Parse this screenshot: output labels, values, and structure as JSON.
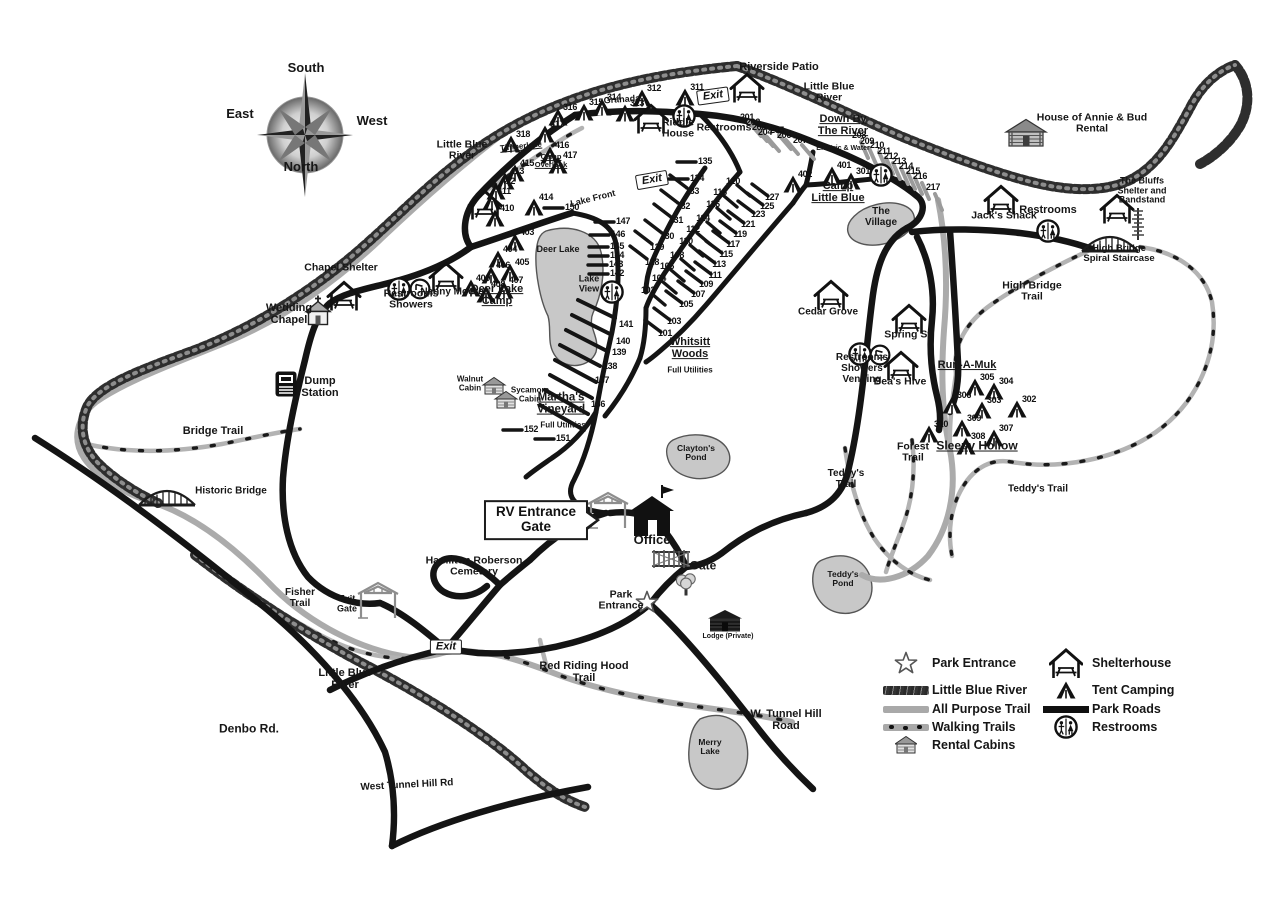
{
  "map_name": "campground-park-map",
  "colors": {
    "road": "#141414",
    "trail": "#ababab",
    "river": "#2e2e2e",
    "lake": "#c8c8c8",
    "text": "#161616"
  },
  "compass": {
    "top": "South",
    "left": "East",
    "right": "West",
    "bottom": "North"
  },
  "legend": {
    "items_left": [
      {
        "icon": "park-entrance-star",
        "label": "Park Entrance"
      },
      {
        "icon": "river-swatch",
        "label": "Little Blue River"
      },
      {
        "icon": "all-purpose-trail-swatch",
        "label": "All Purpose Trail"
      },
      {
        "icon": "walking-trails-swatch",
        "label": "Walking Trails"
      },
      {
        "icon": "rental-cabin",
        "label": "Rental Cabins"
      }
    ],
    "items_right": [
      {
        "icon": "shelterhouse",
        "label": "Shelterhouse"
      },
      {
        "icon": "tent",
        "label": "Tent Camping"
      },
      {
        "icon": "park-roads-swatch",
        "label": "Park Roads"
      },
      {
        "icon": "restrooms",
        "label": "Restrooms"
      }
    ]
  },
  "labels": [
    {
      "id": "compass-south",
      "text": "South",
      "x": 306,
      "y": 68,
      "fs": 13
    },
    {
      "id": "compass-east",
      "text": "East",
      "x": 240,
      "y": 114,
      "fs": 13
    },
    {
      "id": "compass-west",
      "text": "West",
      "x": 372,
      "y": 121,
      "fs": 13
    },
    {
      "id": "compass-north",
      "text": "North",
      "x": 301,
      "y": 167,
      "fs": 13
    },
    {
      "id": "riverside-patio",
      "text": "Riverside Patio",
      "x": 779,
      "y": 68,
      "fs": 11
    },
    {
      "id": "little-blue-river-ne",
      "text": "Little Blue\nRiver",
      "x": 829,
      "y": 93,
      "fs": 10.5
    },
    {
      "id": "house-of-annie-bud",
      "text": "House of Annie & Bud\nRental",
      "x": 1092,
      "y": 124,
      "fs": 10.5
    },
    {
      "id": "granada",
      "text": "Granada",
      "x": 622,
      "y": 100,
      "fs": 9,
      "r": -4
    },
    {
      "id": "riddle-house",
      "text": "Riddle\nHouse",
      "x": 678,
      "y": 129,
      "fs": 10.5
    },
    {
      "id": "restrooms-top",
      "text": "Restrooms",
      "x": 724,
      "y": 128,
      "fs": 10.5
    },
    {
      "id": "down-by-the-river",
      "text": "Down By\nThe River",
      "x": 843,
      "y": 126,
      "fs": 11,
      "u": true
    },
    {
      "id": "electric-and-water",
      "text": "Electric & Water",
      "x": 843,
      "y": 149,
      "fs": 7
    },
    {
      "id": "little-blue-river-w",
      "text": "Little Blue\nRiver",
      "x": 462,
      "y": 151,
      "fs": 10.5
    },
    {
      "id": "timberlake",
      "text": "Timberlake",
      "x": 521,
      "y": 147,
      "fs": 8,
      "u": true,
      "r": -6
    },
    {
      "id": "camp-overlook",
      "text": "Camp\nOverlook",
      "x": 551,
      "y": 161,
      "fs": 7.5,
      "u": true
    },
    {
      "id": "camp-little-blue",
      "text": "Camp\nLittle Blue",
      "x": 838,
      "y": 193,
      "fs": 11,
      "u": true
    },
    {
      "id": "the-village",
      "text": "The\nVillage",
      "x": 881,
      "y": 218,
      "fs": 10
    },
    {
      "id": "jacks-shack",
      "text": "Jack's Shack",
      "x": 1004,
      "y": 216,
      "fs": 10.5
    },
    {
      "id": "restrooms-ne",
      "text": "Restrooms",
      "x": 1048,
      "y": 211,
      "fs": 11
    },
    {
      "id": "the-bluffs",
      "text": "The Bluffs\nShelter and\nBandstand",
      "x": 1142,
      "y": 191,
      "fs": 9
    },
    {
      "id": "lake-front",
      "text": "Lake Front",
      "x": 593,
      "y": 199,
      "fs": 9,
      "r": -14
    },
    {
      "id": "deer-lake",
      "text": "Deer Lake",
      "x": 558,
      "y": 250,
      "fs": 9
    },
    {
      "id": "high-bridge-spiral-staircase",
      "text": "High Bridge\nSpiral Staircase",
      "x": 1119,
      "y": 254,
      "fs": 9.5
    },
    {
      "id": "high-bridge-trail",
      "text": "High Bridge\nTrail",
      "x": 1032,
      "y": 292,
      "fs": 10.5
    },
    {
      "id": "chapel-shelter",
      "text": "Chapel Shelter",
      "x": 341,
      "y": 268,
      "fs": 10.5
    },
    {
      "id": "restrooms-showers-w",
      "text": "Restrooms\nShowers",
      "x": 411,
      "y": 300,
      "fs": 10.5
    },
    {
      "id": "nanny-moore",
      "text": "Nanny Moore",
      "x": 452,
      "y": 293,
      "fs": 10
    },
    {
      "id": "deer-lake-camp",
      "text": "Deer Lake\nCamp",
      "x": 497,
      "y": 296,
      "fs": 11,
      "u": true
    },
    {
      "id": "lake-view",
      "text": "Lake\nView",
      "x": 589,
      "y": 284,
      "fs": 9
    },
    {
      "id": "cedar-grove",
      "text": "Cedar Grove",
      "x": 828,
      "y": 313,
      "fs": 10
    },
    {
      "id": "wedding-chapel",
      "text": "Wedding\nChapel",
      "x": 289,
      "y": 315,
      "fs": 11
    },
    {
      "id": "spring-st",
      "text": "Spring St.",
      "x": 909,
      "y": 335,
      "fs": 10.5
    },
    {
      "id": "restrooms-showers-vending",
      "text": "Restrooms\nShowers\nVending",
      "x": 862,
      "y": 369,
      "fs": 10
    },
    {
      "id": "beas-hive",
      "text": "Bea's Hive",
      "x": 900,
      "y": 382,
      "fs": 10.5
    },
    {
      "id": "run-a-muk",
      "text": "Run-A-Muk",
      "x": 967,
      "y": 366,
      "fs": 11,
      "u": true
    },
    {
      "id": "whitsitt-woods",
      "text": "Whitsitt\nWoods",
      "x": 690,
      "y": 349,
      "fs": 11,
      "u": true
    },
    {
      "id": "whitsitt-full-utilities",
      "text": "Full Utilities",
      "x": 690,
      "y": 371,
      "fs": 8
    },
    {
      "id": "sleepy-hollow",
      "text": "Sleepy Hollow",
      "x": 977,
      "y": 446,
      "fs": 12,
      "u": true
    },
    {
      "id": "dump-station",
      "text": "Dump\nStation",
      "x": 320,
      "y": 388,
      "fs": 11
    },
    {
      "id": "walnut-cabin",
      "text": "Walnut\nCabin",
      "x": 470,
      "y": 384,
      "fs": 8
    },
    {
      "id": "sycamore-cabin",
      "text": "Sycamore\nCabin",
      "x": 530,
      "y": 395,
      "fs": 8
    },
    {
      "id": "marthas-vineyard",
      "text": "Martha's\nVineyard",
      "x": 561,
      "y": 404,
      "fs": 11.5,
      "u": true
    },
    {
      "id": "marthas-full-utilities",
      "text": "Full Utilities",
      "x": 563,
      "y": 426,
      "fs": 8
    },
    {
      "id": "bridge-trail",
      "text": "Bridge Trail",
      "x": 213,
      "y": 432,
      "fs": 11
    },
    {
      "id": "claytons-pond",
      "text": "Clayton's\nPond",
      "x": 696,
      "y": 453,
      "fs": 8.5
    },
    {
      "id": "forest-trail",
      "text": "Forest\nTrail",
      "x": 913,
      "y": 453,
      "fs": 10.5
    },
    {
      "id": "teddys-trail-w",
      "text": "Teddy's\nTrail",
      "x": 846,
      "y": 480,
      "fs": 10
    },
    {
      "id": "teddys-trail-e",
      "text": "Teddy's Trail",
      "x": 1038,
      "y": 490,
      "fs": 10
    },
    {
      "id": "historic-bridge",
      "text": "Historic Bridge",
      "x": 231,
      "y": 492,
      "fs": 10
    },
    {
      "id": "office",
      "text": "Office",
      "x": 652,
      "y": 540,
      "fs": 13
    },
    {
      "id": "hamilton-roberson-cemetery",
      "text": "Hamilton Roberson\nCemetery",
      "x": 474,
      "y": 567,
      "fs": 10.5
    },
    {
      "id": "gate",
      "text": "Gate",
      "x": 703,
      "y": 566,
      "fs": 12
    },
    {
      "id": "teddys-pond",
      "text": "Teddy's\nPond",
      "x": 843,
      "y": 579,
      "fs": 8.5
    },
    {
      "id": "fisher-trail",
      "text": "Fisher\nTrail",
      "x": 300,
      "y": 599,
      "fs": 10
    },
    {
      "id": "exit-gate",
      "text": "Exit\nGate",
      "x": 347,
      "y": 604,
      "fs": 9
    },
    {
      "id": "park-entrance",
      "text": "Park\nEntrance",
      "x": 621,
      "y": 601,
      "fs": 10.5
    },
    {
      "id": "lodge-private",
      "text": "Lodge (Private)",
      "x": 728,
      "y": 637,
      "fs": 7
    },
    {
      "id": "little-blue-river-s",
      "text": "Little Blue\nRiver",
      "x": 345,
      "y": 680,
      "fs": 11
    },
    {
      "id": "red-riding-hood-trail",
      "text": "Red Riding Hood\nTrail",
      "x": 584,
      "y": 673,
      "fs": 11
    },
    {
      "id": "denbo-rd",
      "text": "Denbo Rd.",
      "x": 249,
      "y": 729,
      "fs": 12
    },
    {
      "id": "w-tunnel-hill-road",
      "text": "W. Tunnel Hill\nRoad",
      "x": 786,
      "y": 721,
      "fs": 11
    },
    {
      "id": "merry-lake",
      "text": "Merry\nLake",
      "x": 710,
      "y": 747,
      "fs": 8.5
    },
    {
      "id": "west-tunnel-hill-rd",
      "text": "West Tunnel Hill Rd",
      "x": 407,
      "y": 786,
      "fs": 10,
      "r": -3
    }
  ],
  "signs": [
    {
      "type": "exit",
      "text": "Exit",
      "x": 713,
      "y": 96,
      "r": -8
    },
    {
      "type": "exit",
      "text": "Exit",
      "x": 652,
      "y": 180,
      "r": -10
    },
    {
      "type": "exit",
      "text": "Exit",
      "x": 446,
      "y": 647,
      "r": 0
    },
    {
      "type": "rv",
      "text": "RV Entrance\nGate",
      "x": 536,
      "y": 520,
      "r": 0
    }
  ],
  "campsites": [
    [
      101,
      665,
      333
    ],
    [
      102,
      648,
      290
    ],
    [
      103,
      674,
      321
    ],
    [
      104,
      659,
      278
    ],
    [
      105,
      686,
      304
    ],
    [
      106,
      667,
      266
    ],
    [
      107,
      698,
      294
    ],
    [
      108,
      677,
      255
    ],
    [
      109,
      706,
      284
    ],
    [
      110,
      686,
      241
    ],
    [
      111,
      715,
      275
    ],
    [
      112,
      693,
      229
    ],
    [
      113,
      719,
      264
    ],
    [
      114,
      703,
      218
    ],
    [
      115,
      726,
      254
    ],
    [
      116,
      713,
      204
    ],
    [
      117,
      733,
      244
    ],
    [
      118,
      720,
      192
    ],
    [
      119,
      740,
      234
    ],
    [
      120,
      733,
      181
    ],
    [
      121,
      748,
      224
    ],
    [
      123,
      758,
      214
    ],
    [
      125,
      767,
      206
    ],
    [
      127,
      772,
      197
    ],
    [
      128,
      652,
      262
    ],
    [
      129,
      657,
      247
    ],
    [
      130,
      667,
      236
    ],
    [
      131,
      676,
      220
    ],
    [
      132,
      683,
      206
    ],
    [
      133,
      692,
      191
    ],
    [
      134,
      697,
      178
    ],
    [
      135,
      705,
      161
    ],
    [
      136,
      598,
      404
    ],
    [
      137,
      602,
      380
    ],
    [
      138,
      610,
      366
    ],
    [
      139,
      619,
      352
    ],
    [
      140,
      623,
      341
    ],
    [
      141,
      626,
      324
    ],
    [
      142,
      617,
      273
    ],
    [
      143,
      616,
      264
    ],
    [
      144,
      617,
      255
    ],
    [
      145,
      617,
      246
    ],
    [
      146,
      618,
      234
    ],
    [
      147,
      623,
      221
    ],
    [
      150,
      572,
      207
    ],
    [
      151,
      563,
      438
    ],
    [
      152,
      531,
      429
    ],
    [
      201,
      747,
      117
    ],
    [
      202,
      753,
      122
    ],
    [
      203,
      759,
      127
    ],
    [
      204,
      765,
      132
    ],
    [
      205,
      777,
      130
    ],
    [
      206,
      784,
      135
    ],
    [
      207,
      800,
      140
    ],
    [
      208,
      859,
      135
    ],
    [
      209,
      867,
      141
    ],
    [
      210,
      877,
      145
    ],
    [
      211,
      884,
      151
    ],
    [
      212,
      891,
      156
    ],
    [
      213,
      899,
      161
    ],
    [
      214,
      906,
      166
    ],
    [
      215,
      913,
      171
    ],
    [
      216,
      920,
      176
    ],
    [
      217,
      933,
      187
    ],
    [
      301,
      863,
      171
    ],
    [
      302,
      1029,
      399
    ],
    [
      303,
      994,
      400
    ],
    [
      304,
      1006,
      381
    ],
    [
      305,
      987,
      377
    ],
    [
      306,
      964,
      395
    ],
    [
      307,
      1006,
      428
    ],
    [
      308,
      978,
      436
    ],
    [
      309,
      974,
      418
    ],
    [
      310,
      941,
      424
    ],
    [
      311,
      697,
      87
    ],
    [
      312,
      654,
      88
    ],
    [
      313,
      637,
      103
    ],
    [
      314,
      614,
      97
    ],
    [
      315,
      596,
      102
    ],
    [
      316,
      570,
      107
    ],
    [
      317,
      557,
      124
    ],
    [
      318,
      523,
      134
    ],
    [
      401,
      844,
      165
    ],
    [
      402,
      805,
      174
    ],
    [
      403,
      527,
      232
    ],
    [
      404,
      510,
      249
    ],
    [
      405,
      522,
      262
    ],
    [
      406,
      503,
      265
    ],
    [
      407,
      516,
      280
    ],
    [
      408,
      498,
      284
    ],
    [
      409,
      483,
      278
    ],
    [
      410,
      507,
      208
    ],
    [
      411,
      504,
      191
    ],
    [
      412,
      508,
      181
    ],
    [
      413,
      517,
      171
    ],
    [
      414,
      546,
      197
    ],
    [
      415,
      527,
      163
    ],
    [
      416,
      562,
      145
    ],
    [
      417,
      570,
      155
    ]
  ],
  "features": [
    {
      "type": "shelter",
      "name": "riverside-patio-shelter",
      "x": 747,
      "y": 88
    },
    {
      "type": "shelter",
      "name": "riddle-house-shelter",
      "x": 651,
      "y": 119
    },
    {
      "type": "shelter",
      "name": "chapel-shelter",
      "x": 344,
      "y": 296
    },
    {
      "type": "shelter",
      "name": "nanny-moore-shelter",
      "x": 446,
      "y": 277
    },
    {
      "type": "shelter",
      "name": "deer-lake-shelter",
      "x": 485,
      "y": 205
    },
    {
      "type": "shelter",
      "name": "cedar-grove-shelter",
      "x": 831,
      "y": 295
    },
    {
      "type": "shelter",
      "name": "spring-st-shelter",
      "x": 909,
      "y": 319
    },
    {
      "type": "shelter",
      "name": "beas-hive-shelter",
      "x": 901,
      "y": 366
    },
    {
      "type": "shelter",
      "name": "jacks-shack-shelter",
      "x": 1001,
      "y": 200
    },
    {
      "type": "shelter",
      "name": "the-bluffs-shelter",
      "x": 1117,
      "y": 209
    },
    {
      "type": "restroom",
      "name": "restrooms-top",
      "x": 684,
      "y": 116
    },
    {
      "type": "restroom",
      "name": "restrooms-down-by-river",
      "x": 881,
      "y": 175
    },
    {
      "type": "restroom",
      "name": "restrooms-lake-view",
      "x": 612,
      "y": 292
    },
    {
      "type": "restroom",
      "name": "restrooms-deer-lake",
      "x": 399,
      "y": 289
    },
    {
      "type": "restroom",
      "name": "restrooms-vending",
      "x": 860,
      "y": 354
    },
    {
      "type": "restroom",
      "name": "restrooms-ne",
      "x": 1048,
      "y": 231
    },
    {
      "type": "shower",
      "name": "showers-deer-lake",
      "x": 420,
      "y": 289
    },
    {
      "type": "shower",
      "name": "showers-vending",
      "x": 880,
      "y": 355
    },
    {
      "type": "cabin",
      "name": "walnut-cabin",
      "x": 494,
      "y": 386
    },
    {
      "type": "cabin",
      "name": "sycamore-cabin",
      "x": 506,
      "y": 400
    },
    {
      "type": "logcabin",
      "name": "house-of-annie-bud-cabin",
      "x": 1026,
      "y": 133
    },
    {
      "type": "office",
      "name": "office-building",
      "x": 652,
      "y": 511
    },
    {
      "type": "church",
      "name": "wedding-chapel-church",
      "x": 318,
      "y": 310
    },
    {
      "type": "star",
      "name": "park-entrance-star",
      "x": 647,
      "y": 602
    },
    {
      "type": "gatestructure",
      "name": "rv-entrance-gate-structure",
      "x": 608,
      "y": 511
    },
    {
      "type": "gatestructure",
      "name": "exit-gate-structure",
      "x": 378,
      "y": 601
    },
    {
      "type": "fencegate",
      "name": "main-gate",
      "x": 671,
      "y": 559
    },
    {
      "type": "tree",
      "name": "gate-tree",
      "x": 686,
      "y": 583
    },
    {
      "type": "bridge",
      "name": "historic-bridge",
      "x": 167,
      "y": 497
    },
    {
      "type": "bridge",
      "name": "high-bridge",
      "x": 1110,
      "y": 243
    },
    {
      "type": "spiral",
      "name": "spiral-staircase",
      "x": 1138,
      "y": 224
    },
    {
      "type": "dump",
      "name": "dump-station-icon",
      "x": 286,
      "y": 384
    },
    {
      "type": "lodge",
      "name": "lodge-building",
      "x": 725,
      "y": 621
    }
  ]
}
